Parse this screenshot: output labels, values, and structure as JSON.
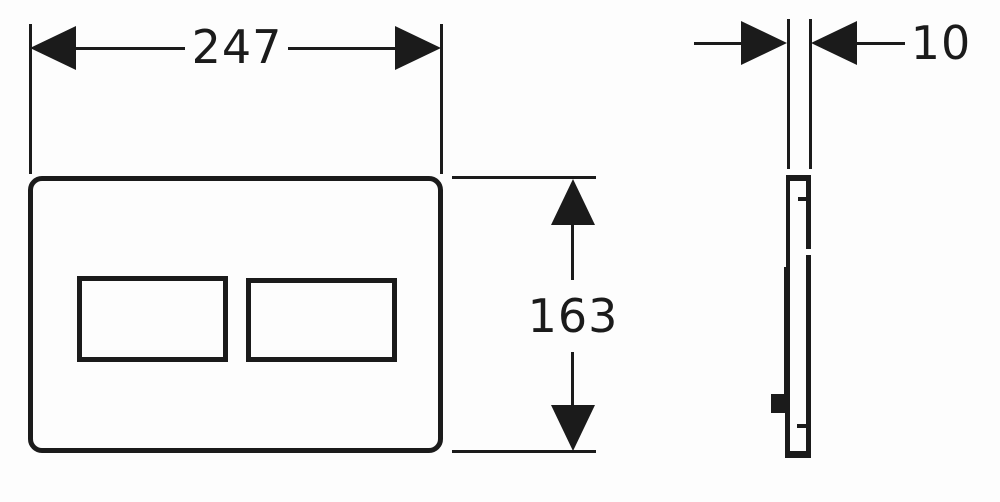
{
  "colors": {
    "line": "#1b1b1b",
    "background": "#fdfdfd"
  },
  "dimensions": {
    "width": "247",
    "height": "163",
    "thickness": "10"
  }
}
